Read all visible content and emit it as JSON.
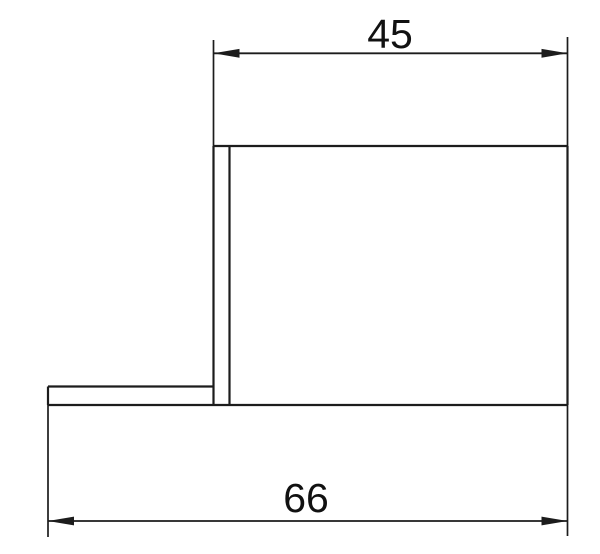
{
  "drawing": {
    "kind": "cad-orthographic-view",
    "background": "#ffffff",
    "line_color": "#1c1c1c",
    "dimensions": {
      "top": {
        "label": "45",
        "orientation": "horizontal"
      },
      "bottom": {
        "label": "66",
        "orientation": "horizontal"
      }
    }
  }
}
